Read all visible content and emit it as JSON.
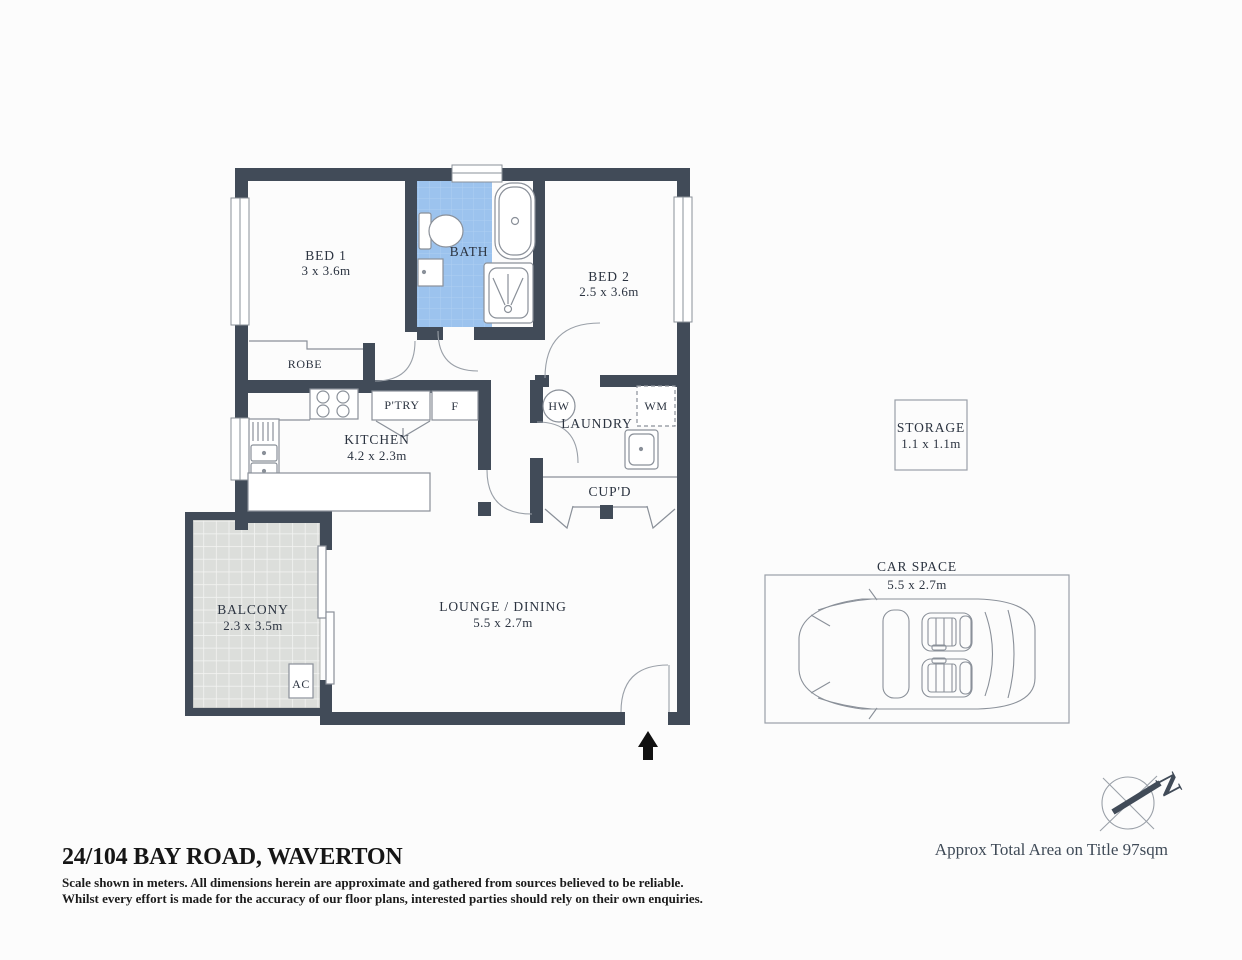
{
  "colors": {
    "wall": "#414b58",
    "bath_fill": "#9cc3ee",
    "bath_grid": "#aecff2",
    "balcony_fill": "#dcdedb",
    "balcony_grid": "#f2f3f1",
    "fixture_stroke": "#9aa0a8",
    "label_text": "#2b3340",
    "entry_arrow": "#111111"
  },
  "rooms": {
    "bed1": {
      "name": "BED 1",
      "dims": "3 x 3.6m"
    },
    "bath": {
      "name": "BATH"
    },
    "bed2": {
      "name": "BED 2",
      "dims": "2.5 x 3.6m"
    },
    "robe": {
      "name": "ROBE"
    },
    "kitchen": {
      "name": "KITCHEN",
      "dims": "4.2 x 2.3m"
    },
    "pantry": {
      "name": "P'TRY"
    },
    "fridge": {
      "name": "F"
    },
    "hot_water": {
      "name": "HW"
    },
    "laundry": {
      "name": "LAUNDRY"
    },
    "washing_machine": {
      "name": "WM"
    },
    "cupboard": {
      "name": "CUP'D"
    },
    "balcony": {
      "name": "BALCONY",
      "dims": "2.3 x 3.5m"
    },
    "air_con": {
      "name": "AC"
    },
    "lounge": {
      "name": "LOUNGE / DINING",
      "dims": "5.5 x 2.7m"
    },
    "storage": {
      "name": "STORAGE",
      "dims": "1.1 x 1.1m"
    },
    "car_space": {
      "name": "CAR SPACE",
      "dims": "5.5 x 2.7m"
    }
  },
  "compass": {
    "label": "N"
  },
  "footer": {
    "title": "24/104 BAY ROAD, WAVERTON",
    "disclaimer_line1": "Scale shown in meters. All dimensions herein are approximate and gathered from sources believed to be  reliable.",
    "disclaimer_line2": "Whilst every effort is made for the accuracy of our floor plans, interested parties should rely on their own enquiries.",
    "area_note": "Approx Total Area on Title 97sqm"
  }
}
